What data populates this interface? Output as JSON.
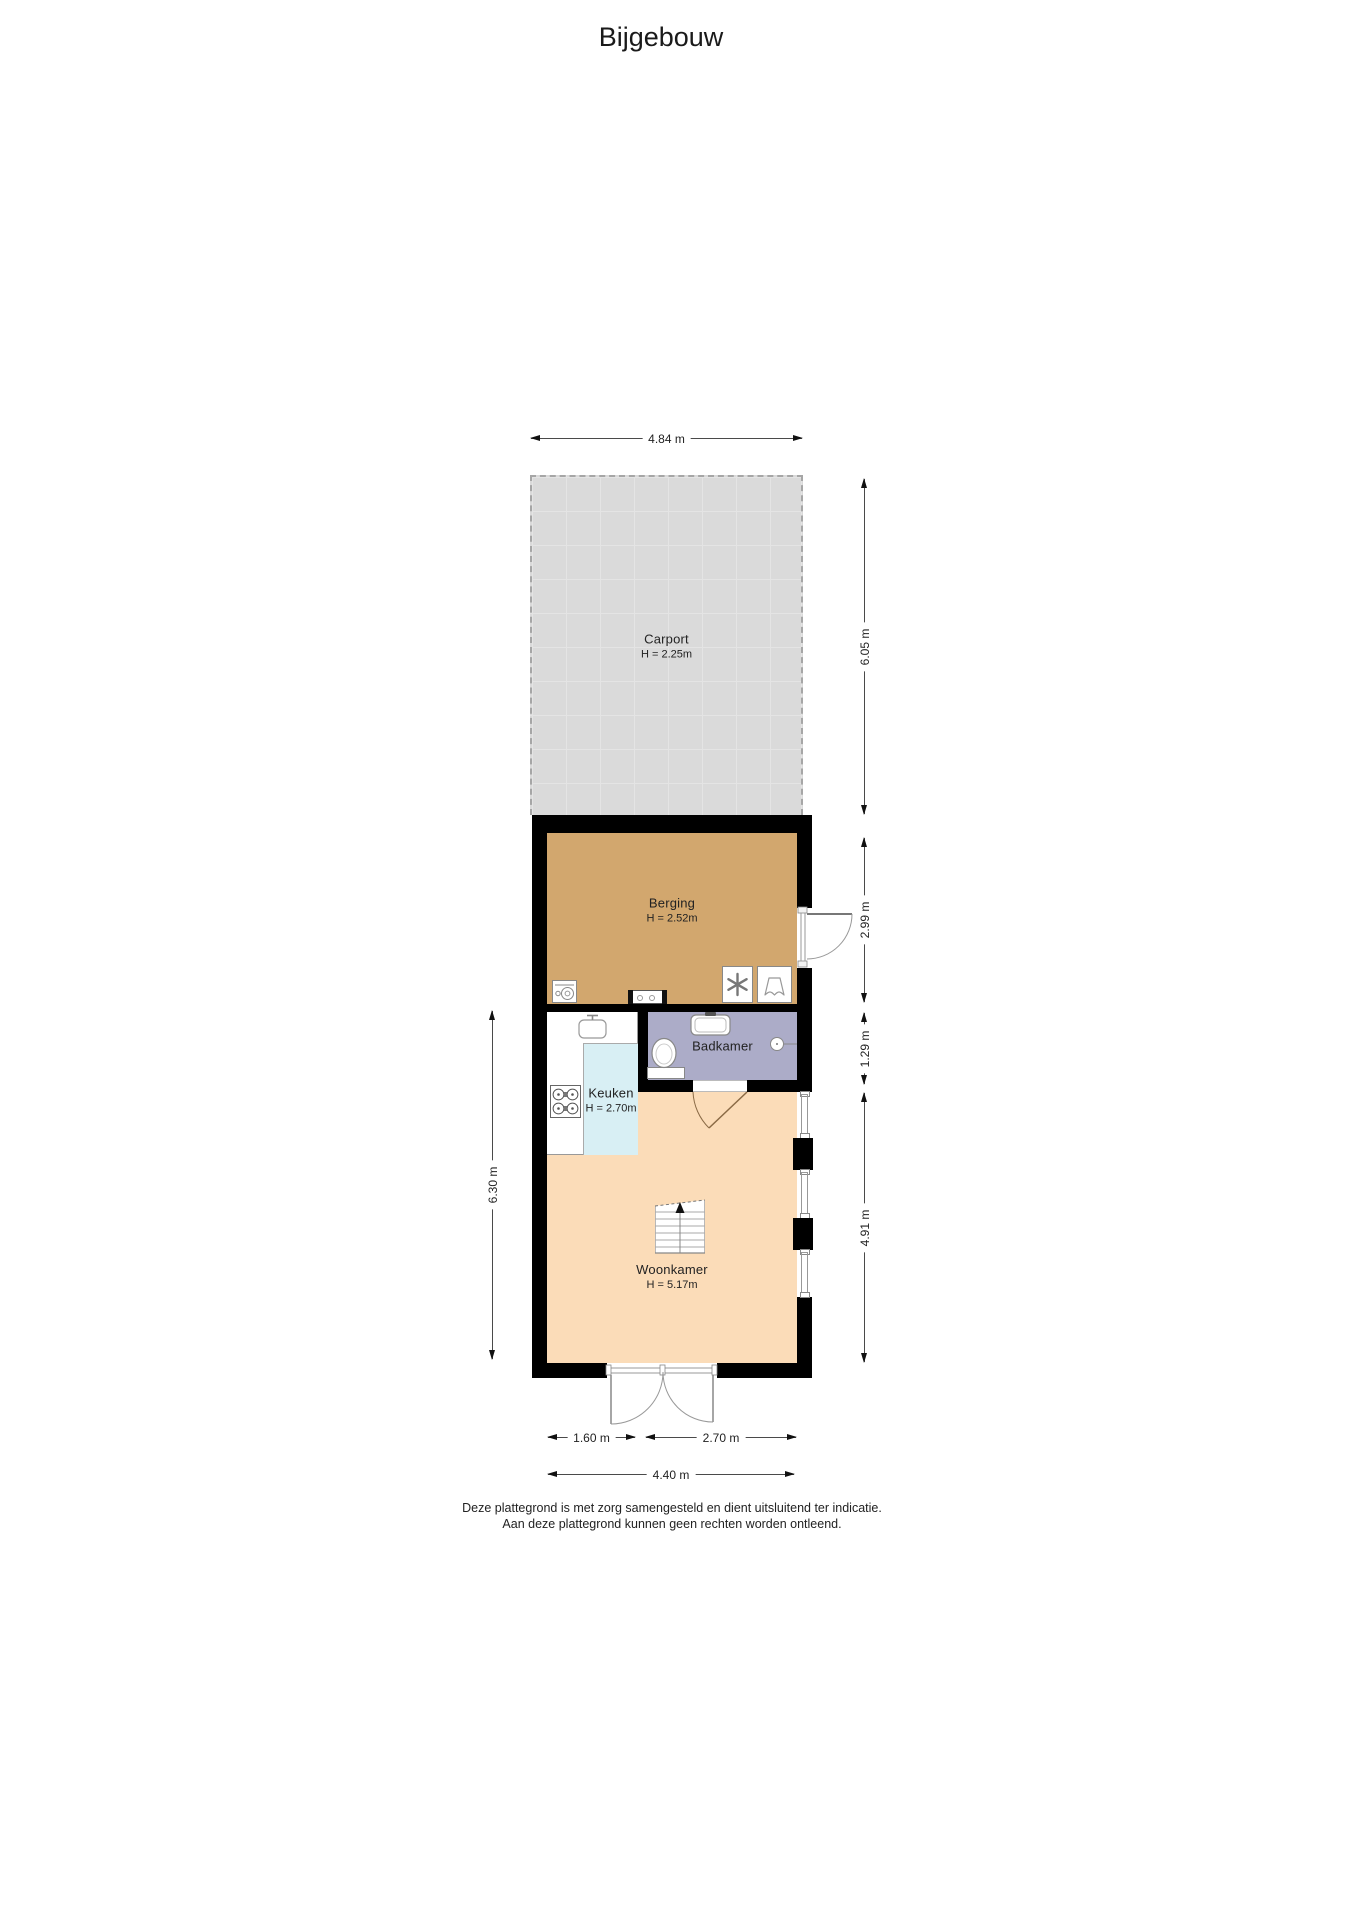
{
  "title": "Bijgebouw",
  "rooms": {
    "carport": {
      "name": "Carport",
      "height": "H = 2.25m"
    },
    "berging": {
      "name": "Berging",
      "height": "H = 2.52m"
    },
    "badkamer": {
      "name": "Badkamer"
    },
    "keuken": {
      "name": "Keuken",
      "height": "H = 2.70m"
    },
    "woonkamer": {
      "name": "Woonkamer",
      "height": "H = 5.17m"
    }
  },
  "dimensions": {
    "carport_width": "4.84 m",
    "carport_depth": "6.05 m",
    "berging_depth": "2.99 m",
    "badkamer_depth": "1.29 m",
    "woonkamer_depth": "4.91 m",
    "interior_left": "6.30 m",
    "keuken_width": "1.60 m",
    "woonkamer_width": "2.70 m",
    "building_width": "4.40 m"
  },
  "disclaimer": {
    "line1": "Deze plattegrond is met zorg samengesteld en dient uitsluitend ter indicatie.",
    "line2": "Aan deze plattegrond kunnen geen rechten worden ontleend."
  },
  "colors": {
    "carport_floor": "#dadada",
    "berging_floor": "#d2a76e",
    "badkamer_floor": "#acacc8",
    "keuken_floor": "#d8eff4",
    "woonkamer_floor": "#fbdcb8",
    "wall": "#000000"
  },
  "icons": {
    "washing_machine": "drum-circle-box",
    "ventilation_unit": "six-spoke-fan",
    "boiler_unit": "tank-outline",
    "utility_sink": "wall-inset-unit",
    "toilet": "bowl-and-tank",
    "bathroom_sink": "basin-with-tap",
    "wall_light": "circle-with-stem",
    "kitchen_sink": "basin-with-tap",
    "stove": "four-burner-hob",
    "stairs": "treads-with-up-arrow",
    "doors": "quarter-circle-swing"
  }
}
